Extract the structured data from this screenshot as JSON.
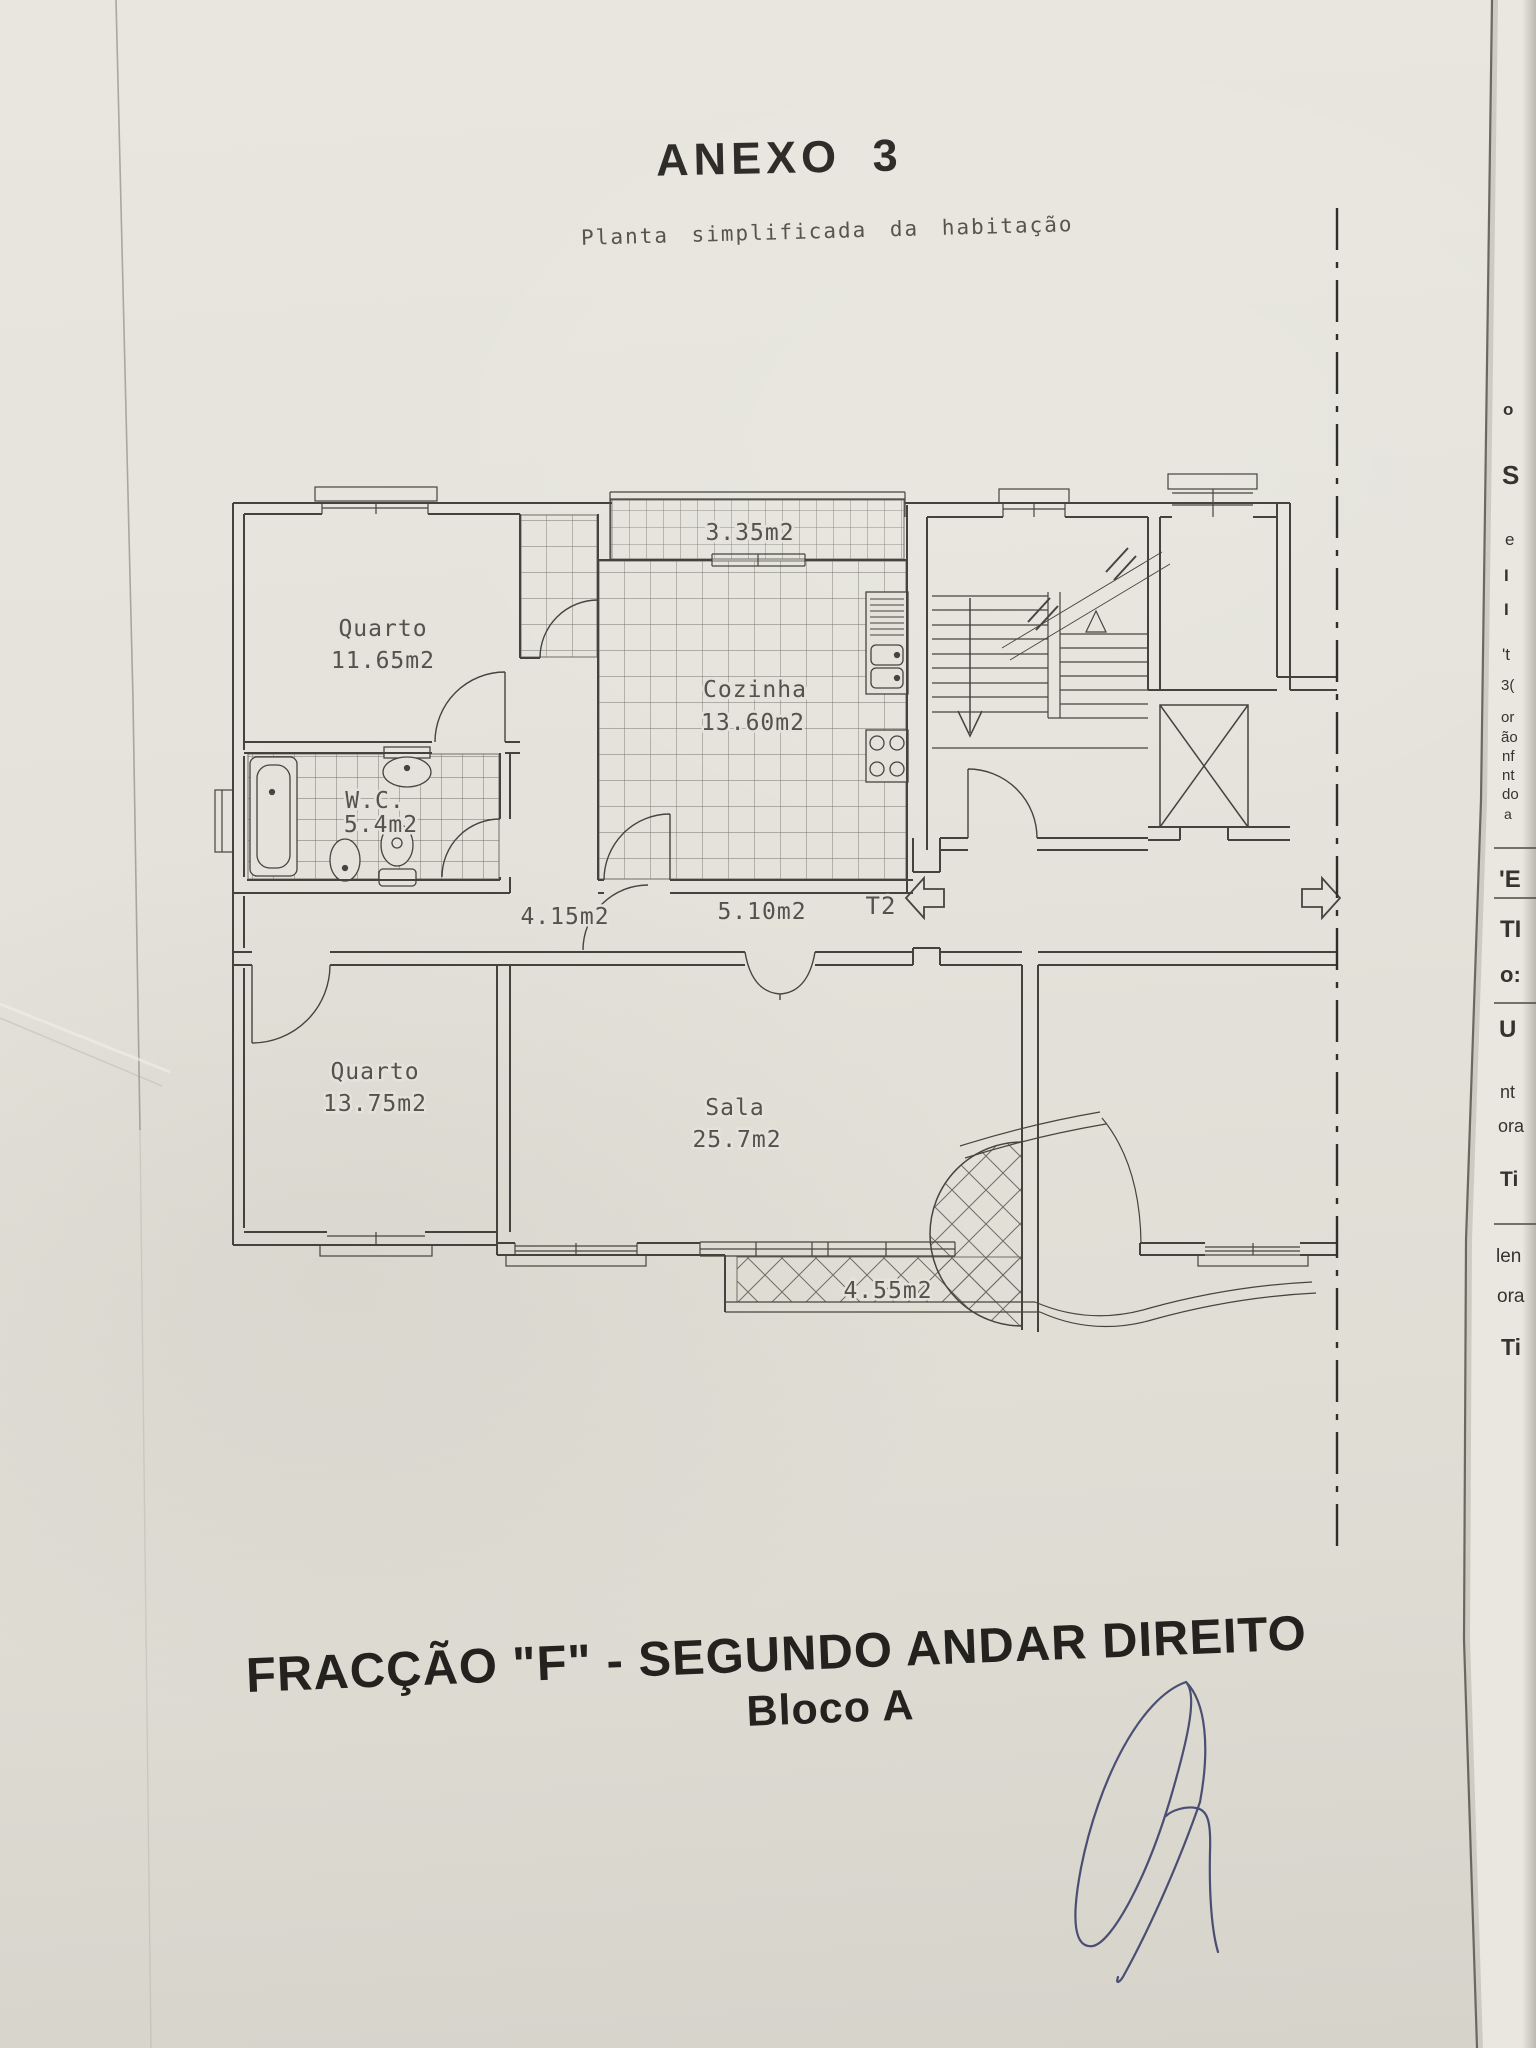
{
  "document": {
    "annex_title": "ANEXO 3",
    "annex_subtitle": "Planta simplificada da habitação",
    "fraction_title": "FRACÇÃO  \"F\" - SEGUNDO ANDAR DIREITO",
    "fraction_subtitle": "Bloco A"
  },
  "plan": {
    "rooms": [
      {
        "name": "Quarto",
        "area": "11.65m2"
      },
      {
        "name": "Cozinha",
        "area": "13.60m2"
      },
      {
        "name": "W.C.",
        "area": "5.4m2"
      },
      {
        "name": "Quarto",
        "area": "13.75m2"
      },
      {
        "name": "Sala",
        "area": "25.7m2"
      }
    ],
    "areas": {
      "top_balcony": "3.35m2",
      "hall": "4.15m2",
      "corridor": "5.10m2",
      "bottom_balcony": "4.55m2"
    },
    "unit_label": "T2"
  },
  "edge_fragments": [
    "o",
    "S",
    "e",
    "I",
    "I",
    "'t",
    "3(",
    "or",
    "ão",
    "nf",
    "nt",
    "do",
    "a",
    "'E",
    "TI",
    "o:",
    "U",
    "nt",
    "ora",
    "Ti",
    "len",
    "ora",
    "Ti"
  ]
}
